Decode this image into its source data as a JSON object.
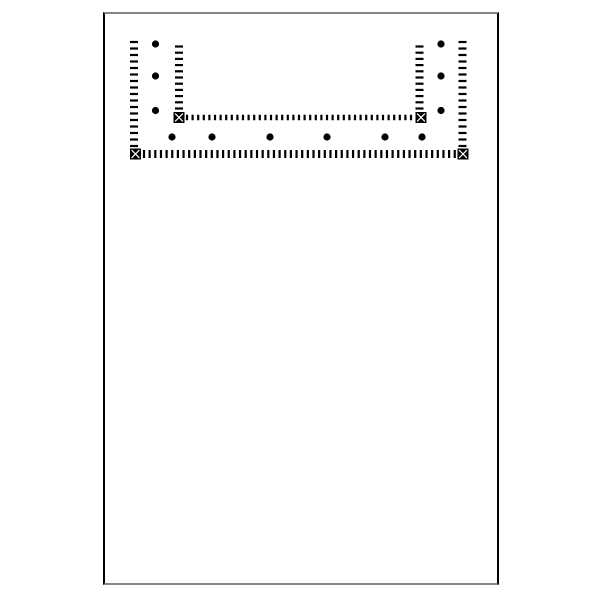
{
  "canvas": {
    "width": 600,
    "height": 600,
    "background_color": "#ffffff"
  },
  "sheet": {
    "x": 103,
    "y": 12,
    "width": 396,
    "height": 573,
    "fill_color": "#ffffff",
    "side_border_color": "#000000",
    "cap_border_color": "#848484",
    "side_border_width": 2,
    "cap_border_width": 2
  },
  "diagram": {
    "ink_color": "#000000",
    "marker_fill_color": "#000000",
    "marker_x_color": "#ffffff",
    "marker_size": 11,
    "dot_radius": 3.6,
    "tick_lines": [
      {
        "name": "outer-left-wall-hatch",
        "orientation": "vertical",
        "x": 134,
        "from": 42,
        "count": 17,
        "pitch": 6.5,
        "dash_w": 8,
        "dash_h": 2.2
      },
      {
        "name": "outer-right-wall-hatch",
        "orientation": "vertical",
        "x": 462.5,
        "from": 42,
        "count": 17,
        "pitch": 6.5,
        "dash_w": 8,
        "dash_h": 2.2
      },
      {
        "name": "inner-left-wall-hatch",
        "orientation": "vertical",
        "x": 179,
        "from": 46.5,
        "count": 11,
        "pitch": 6.2,
        "dash_w": 8,
        "dash_h": 2.2
      },
      {
        "name": "inner-right-wall-hatch",
        "orientation": "vertical",
        "x": 419.5,
        "from": 46.5,
        "count": 11,
        "pitch": 6.2,
        "dash_w": 8,
        "dash_h": 2.2
      },
      {
        "name": "inner-bottom-wall-hatch",
        "orientation": "horizontal",
        "y": 117.5,
        "from": 187,
        "count": 41,
        "pitch": 5.6,
        "dash_w": 2.2,
        "dash_h": 5.5
      },
      {
        "name": "outer-bottom-wall-hatch",
        "orientation": "horizontal",
        "y": 154,
        "from": 144,
        "count": 56,
        "pitch": 5.65,
        "dash_w": 2.2,
        "dash_h": 8
      }
    ],
    "corner_markers": [
      {
        "name": "outer-left-corner-marker",
        "x": 135.5,
        "y": 154
      },
      {
        "name": "outer-right-corner-marker",
        "x": 463,
        "y": 154
      },
      {
        "name": "inner-left-corner-marker",
        "x": 179,
        "y": 117.5
      },
      {
        "name": "inner-right-corner-marker",
        "x": 421,
        "y": 117.5
      }
    ],
    "dots": [
      {
        "x": 155.5,
        "y": 44
      },
      {
        "x": 155.5,
        "y": 76
      },
      {
        "x": 155.5,
        "y": 110.5
      },
      {
        "x": 441,
        "y": 44
      },
      {
        "x": 441,
        "y": 76
      },
      {
        "x": 441,
        "y": 110.5
      },
      {
        "x": 172,
        "y": 137
      },
      {
        "x": 212,
        "y": 137
      },
      {
        "x": 270,
        "y": 137
      },
      {
        "x": 327,
        "y": 137
      },
      {
        "x": 385,
        "y": 137
      },
      {
        "x": 422,
        "y": 137
      }
    ]
  }
}
